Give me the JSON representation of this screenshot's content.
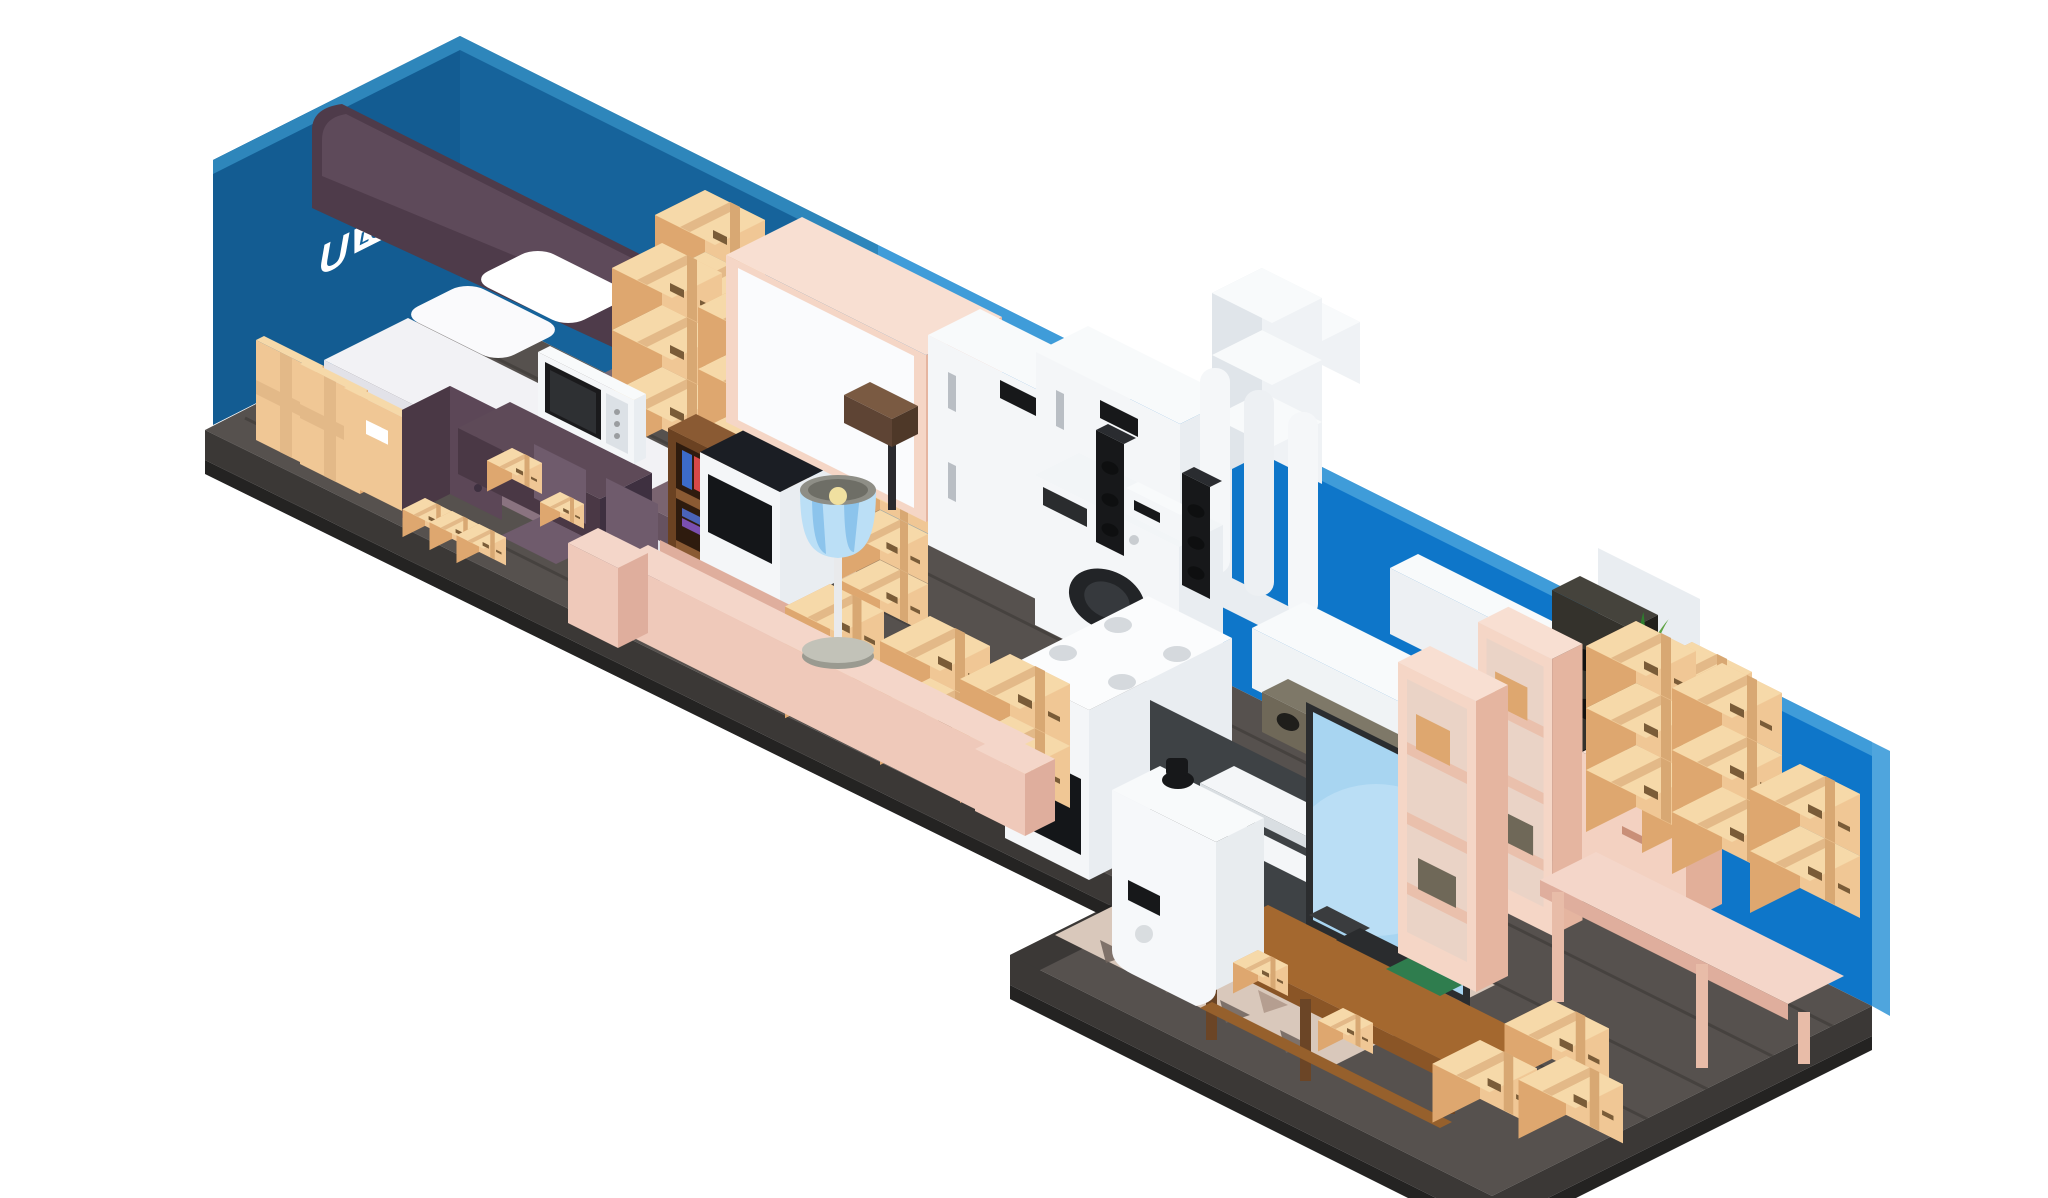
{
  "scene": {
    "alt": "Isometric cutaway illustration of a long self-storage unit with blue walls packed with household furniture, appliances and cardboard boxes",
    "logo": {
      "letter": "U",
      "line1": "STORE",
      "line2": "LOCK"
    },
    "colors": {
      "wall_left": "#135C92",
      "wall_back": "#16639B",
      "wall_right": "#0E76C9",
      "wall_top_band": "#3F9CD9",
      "floor": "#56514E",
      "floor_edge": "#3B3836",
      "box_top": "#F6D9A9",
      "box_light": "#F0C795",
      "box_dark": "#DEA76F",
      "peach_furniture": "#F5D6C6",
      "sofa_pink": "#EFC9BA",
      "lamp_shade_blue": "#BBDFF6",
      "tv_screen_blue": "#A8D5F1",
      "plant_pot_blue": "#5B7FB5",
      "wood_brown": "#A4682F",
      "headboard_purple": "#4E3B4A"
    },
    "objects": [
      "cardboard-boxes",
      "flat-packed-boxes",
      "double-bed",
      "pillows",
      "nightstand",
      "desk",
      "microwave-oven",
      "chairs",
      "bookshelf",
      "electric-stove",
      "mirrored-wardrobe",
      "toolbox",
      "floor-lamp",
      "sofa",
      "refrigerators",
      "washing-machine",
      "hifi-speakers",
      "white-columns",
      "gas-stove",
      "water-heater",
      "air-conditioner",
      "audio-shelf",
      "stereo-receiver",
      "tv-set",
      "tv-bench",
      "laptop",
      "tower-speaker",
      "pink-shelving",
      "potted-plant",
      "chest-of-drawers",
      "side-table",
      "patterned-rug"
    ]
  }
}
